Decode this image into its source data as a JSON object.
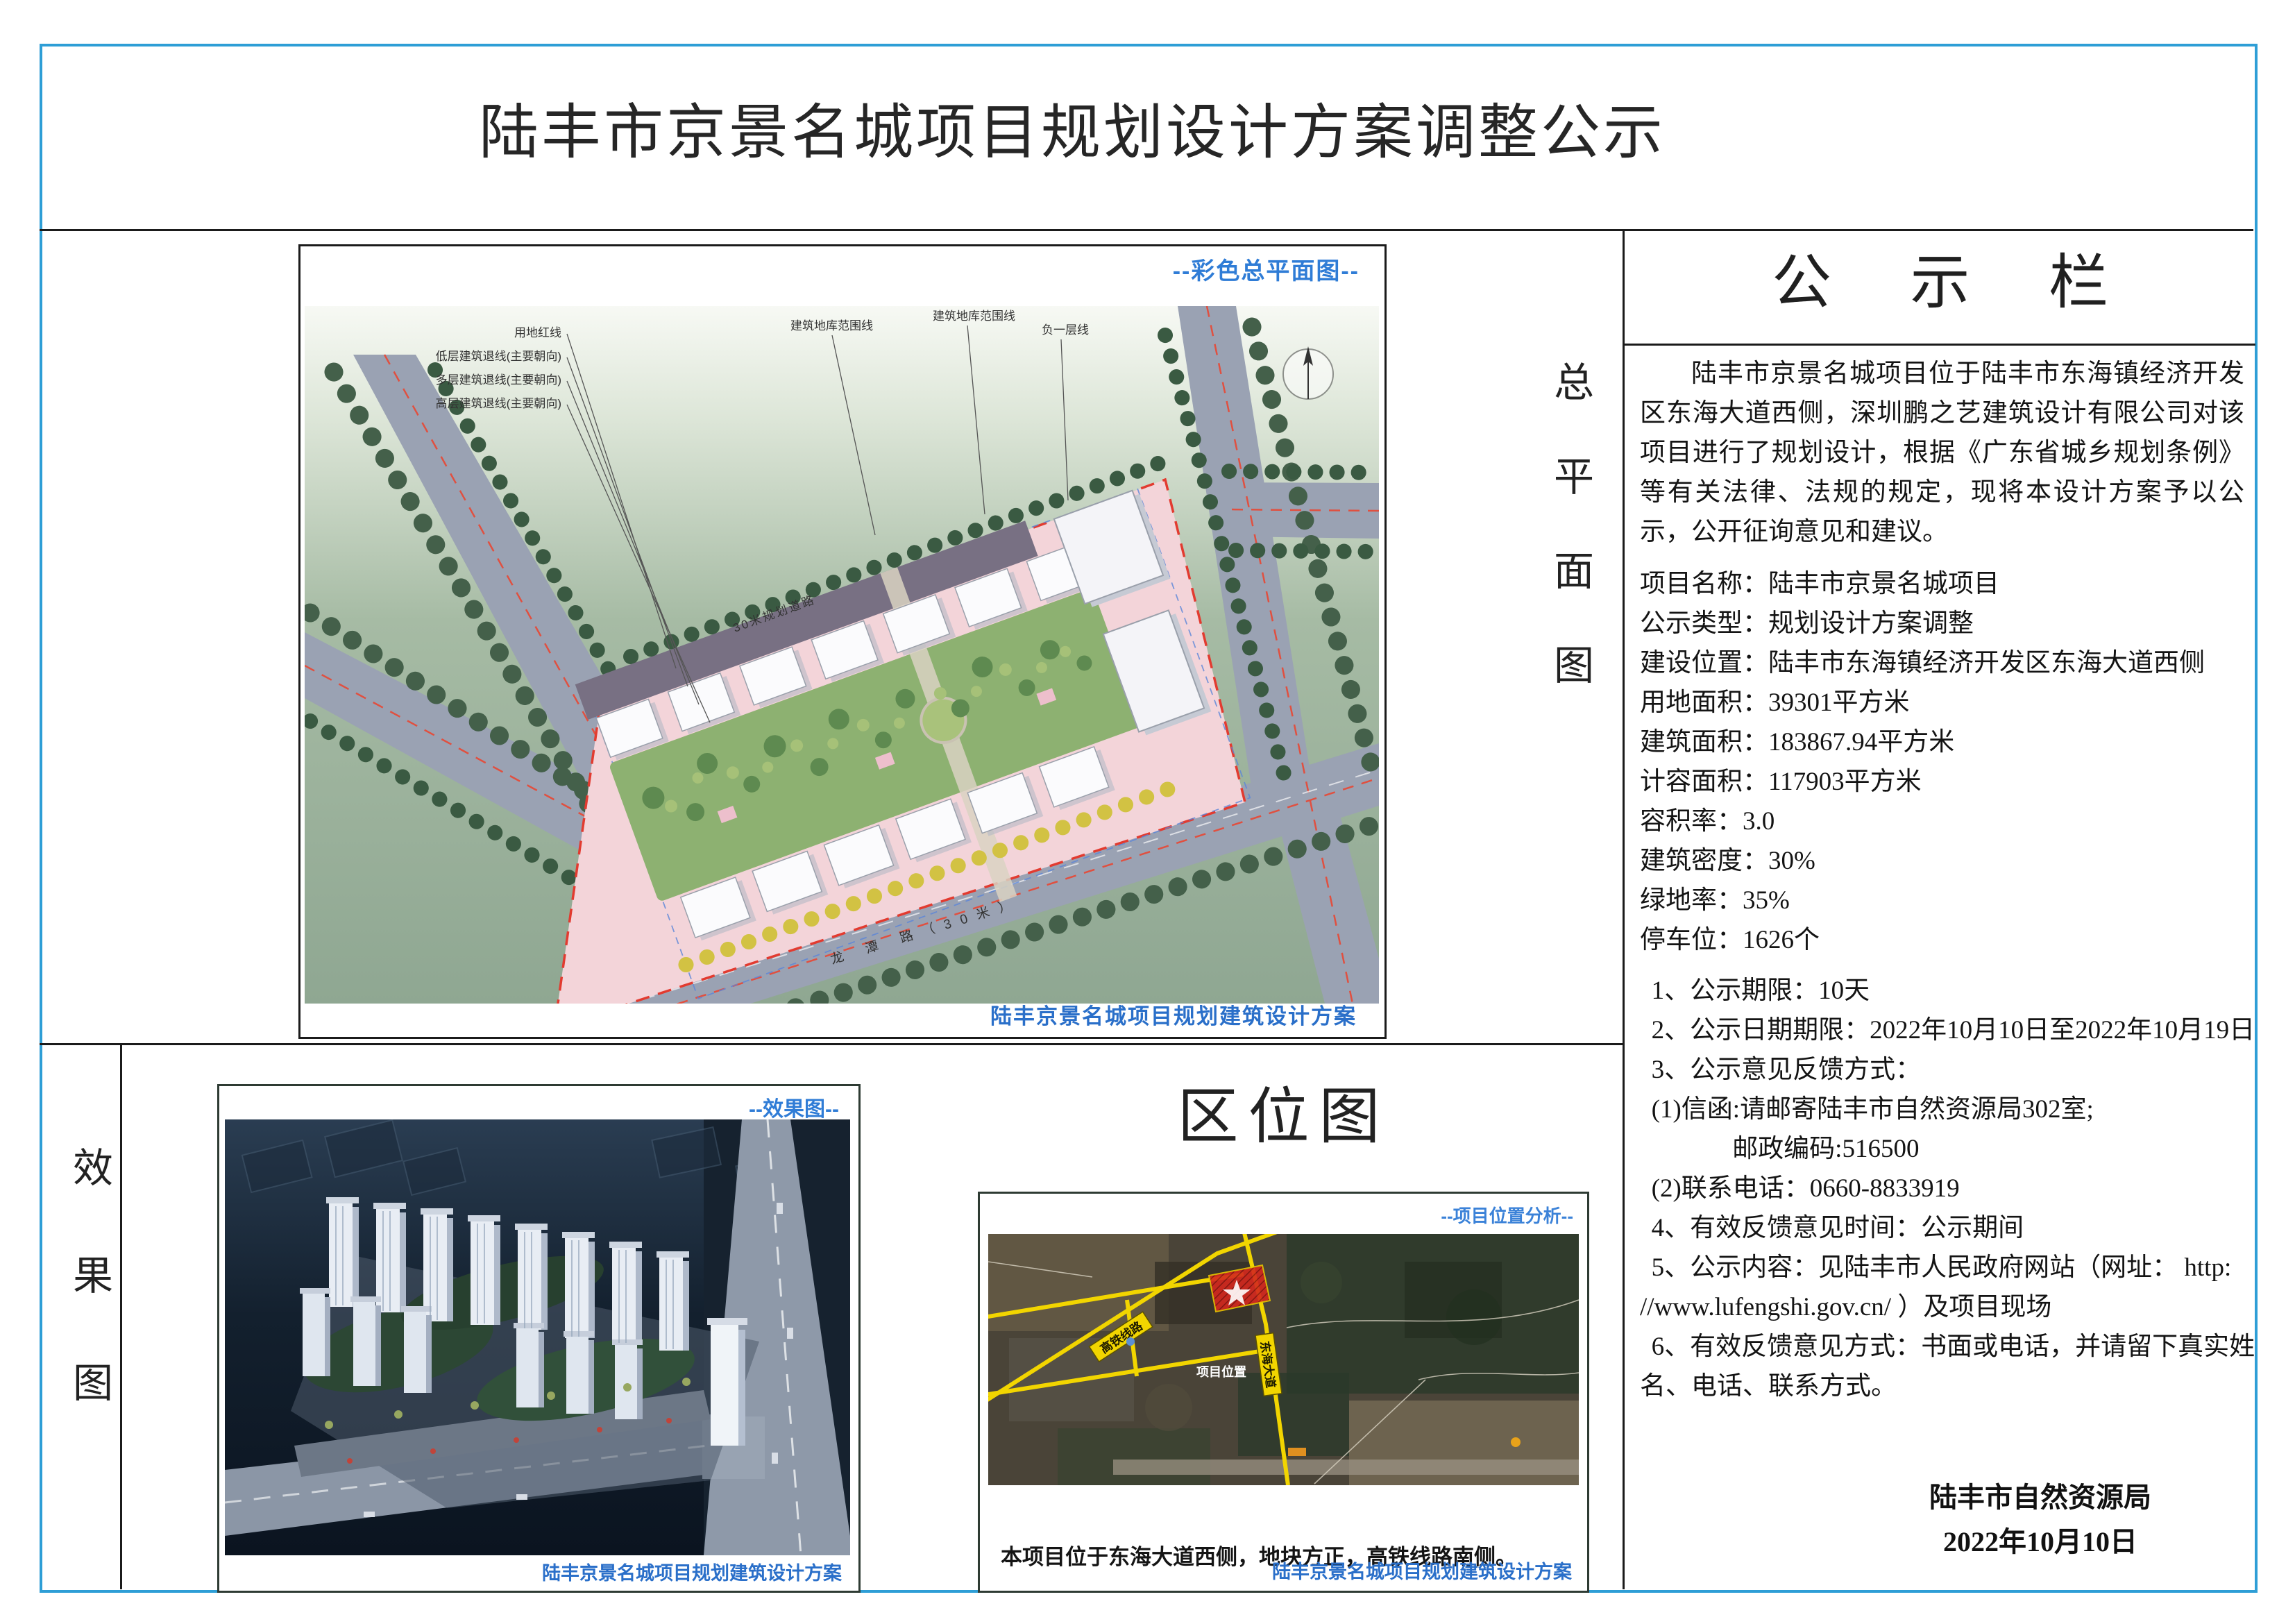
{
  "page": {
    "title": "陆丰市京景名城项目规划设计方案调整公示"
  },
  "colors": {
    "frame_blue": "#2e9ed6",
    "label_blue": "#2f7cd6",
    "boundary_red": "#e23b30",
    "map_road_yellow": "#f2d500"
  },
  "site_plan": {
    "side_label": "总平面图",
    "corner_label": "--彩色总平面图--",
    "caption": "陆丰京景名城项目规划建筑设计方案",
    "annotations": {
      "red_line": "用地红线",
      "low_setback": "低层建筑退线(主要朝向)",
      "mid_setback": "多层建筑退线(主要朝向)",
      "high_setback": "高层建筑退线(主要朝向)",
      "basement_line": "建筑地库范围线",
      "sub_line": "负一层线",
      "road_top": "30米规划道路",
      "road_bottom": "龙 潭 路（30米）"
    }
  },
  "rendering": {
    "side_label": "效果图",
    "corner_label": "--效果图--",
    "caption": "陆丰京景名城项目规划建筑设计方案"
  },
  "location_map": {
    "title": "区位图",
    "corner_label": "--项目位置分析--",
    "rail_label": "高铁线路",
    "avenue_label": "东海大道",
    "marker_label": "项目位置",
    "note": "本项目位于东海大道西侧，地块方正，高铁线路南侧。",
    "caption": "陆丰京景名城项目规划建筑设计方案"
  },
  "notice": {
    "header": "公 示 栏",
    "intro": "陆丰市京景名城项目位于陆丰市东海镇经济开发区东海大道西侧，深圳鹏之艺建筑设计有限公司对该项目进行了规划设计，根据《广东省城乡规划条例》等有关法律、法规的规定，现将本设计方案予以公示，公开征询意见和建议。",
    "fields": [
      {
        "label": "项目名称：",
        "value": "陆丰市京景名城项目"
      },
      {
        "label": "公示类型：",
        "value": "规划设计方案调整"
      },
      {
        "label": "建设位置：",
        "value": "陆丰市东海镇经济开发区东海大道西侧"
      },
      {
        "label": "用地面积：",
        "value": "39301平方米"
      },
      {
        "label": "建筑面积：",
        "value": "183867.94平方米"
      },
      {
        "label": "计容面积：",
        "value": "117903平方米"
      },
      {
        "label": "容积率：",
        "value": "3.0"
      },
      {
        "label": "建筑密度：",
        "value": "30%"
      },
      {
        "label": "绿地率：",
        "value": "35%"
      },
      {
        "label": "停车位：",
        "value": "1626个"
      }
    ],
    "items": [
      "1、公示期限：10天",
      "2、公示日期期限：2022年10月10日至2022年10月19日",
      "3、公示意见反馈方式：",
      "(1)信函:请邮寄陆丰市自然资源局302室;",
      "邮政编码:516500",
      "(2)联系电话：0660-8833919",
      "4、有效反馈意见时间：公示期间",
      "5、公示内容：见陆丰市人民政府网站（网址： http:",
      "//www.lufengshi.gov.cn/ ）及项目现场",
      "6、有效反馈意见方式：书面或电话，并请留下真实姓",
      "名、电话、联系方式。"
    ],
    "agency": "陆丰市自然资源局",
    "date": "2022年10月10日"
  }
}
